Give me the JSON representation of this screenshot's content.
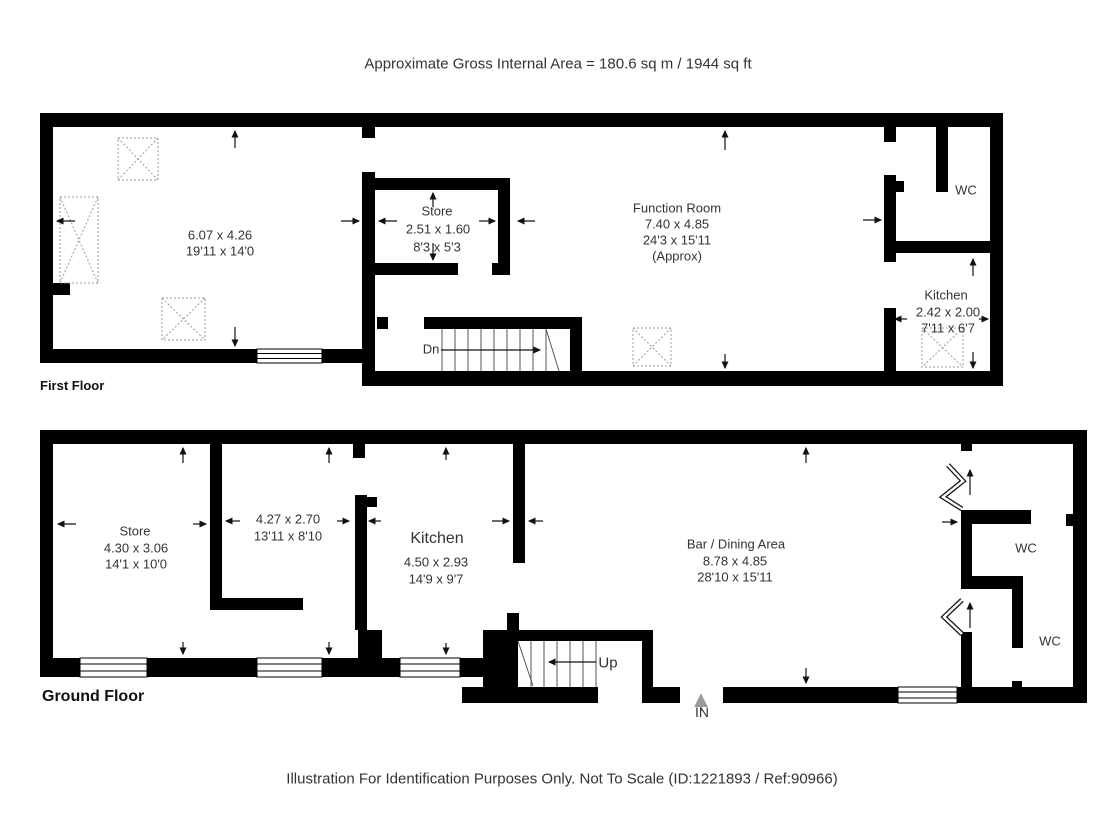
{
  "colors": {
    "wall": "#000000",
    "text": "#333333",
    "dashed_symbol": "#9a9a9a",
    "entry_arrow": "#9a9a9a"
  },
  "header": {
    "title": "Approximate Gross Internal Area = 180.6 sq m / 1944 sq ft"
  },
  "footer": {
    "note": "Illustration For Identification Purposes Only. Not To Scale (ID:1221893 / Ref:90966)"
  },
  "first_floor": {
    "title": "First Floor",
    "main_room": {
      "dims_m": "6.07 x 4.26",
      "dims_ft": "19'11 x 14'0"
    },
    "store": {
      "name": "Store",
      "dims_m": "2.51 x 1.60",
      "dims_ft": "8'3 x 5'3"
    },
    "function_room": {
      "name": "Function Room",
      "dims_m": "7.40 x 4.85",
      "dims_ft": "24'3 x 15'11",
      "note": "(Approx)"
    },
    "wc": {
      "name": "WC"
    },
    "kitchen": {
      "name": "Kitchen",
      "dims_m": "2.42 x 2.00",
      "dims_ft": "7'11 x 6'7"
    },
    "stairs": {
      "label": "Dn"
    }
  },
  "ground_floor": {
    "title": "Ground Floor",
    "store": {
      "name": "Store",
      "dims_m": "4.30 x 3.06",
      "dims_ft": "14'1 x 10'0"
    },
    "room_2": {
      "dims_m": "4.27 x 2.70",
      "dims_ft": "13'11 x 8'10"
    },
    "kitchen": {
      "name": "Kitchen",
      "dims_m": "4.50 x 2.93",
      "dims_ft": "14'9 x 9'7"
    },
    "bar_dining": {
      "name": "Bar / Dining Area",
      "dims_m": "8.78 x 4.85",
      "dims_ft": "28'10 x 15'11"
    },
    "wc_1": {
      "name": "WC"
    },
    "wc_2": {
      "name": "WC"
    },
    "stairs": {
      "label": "Up"
    },
    "entrance": {
      "label": "IN"
    }
  }
}
